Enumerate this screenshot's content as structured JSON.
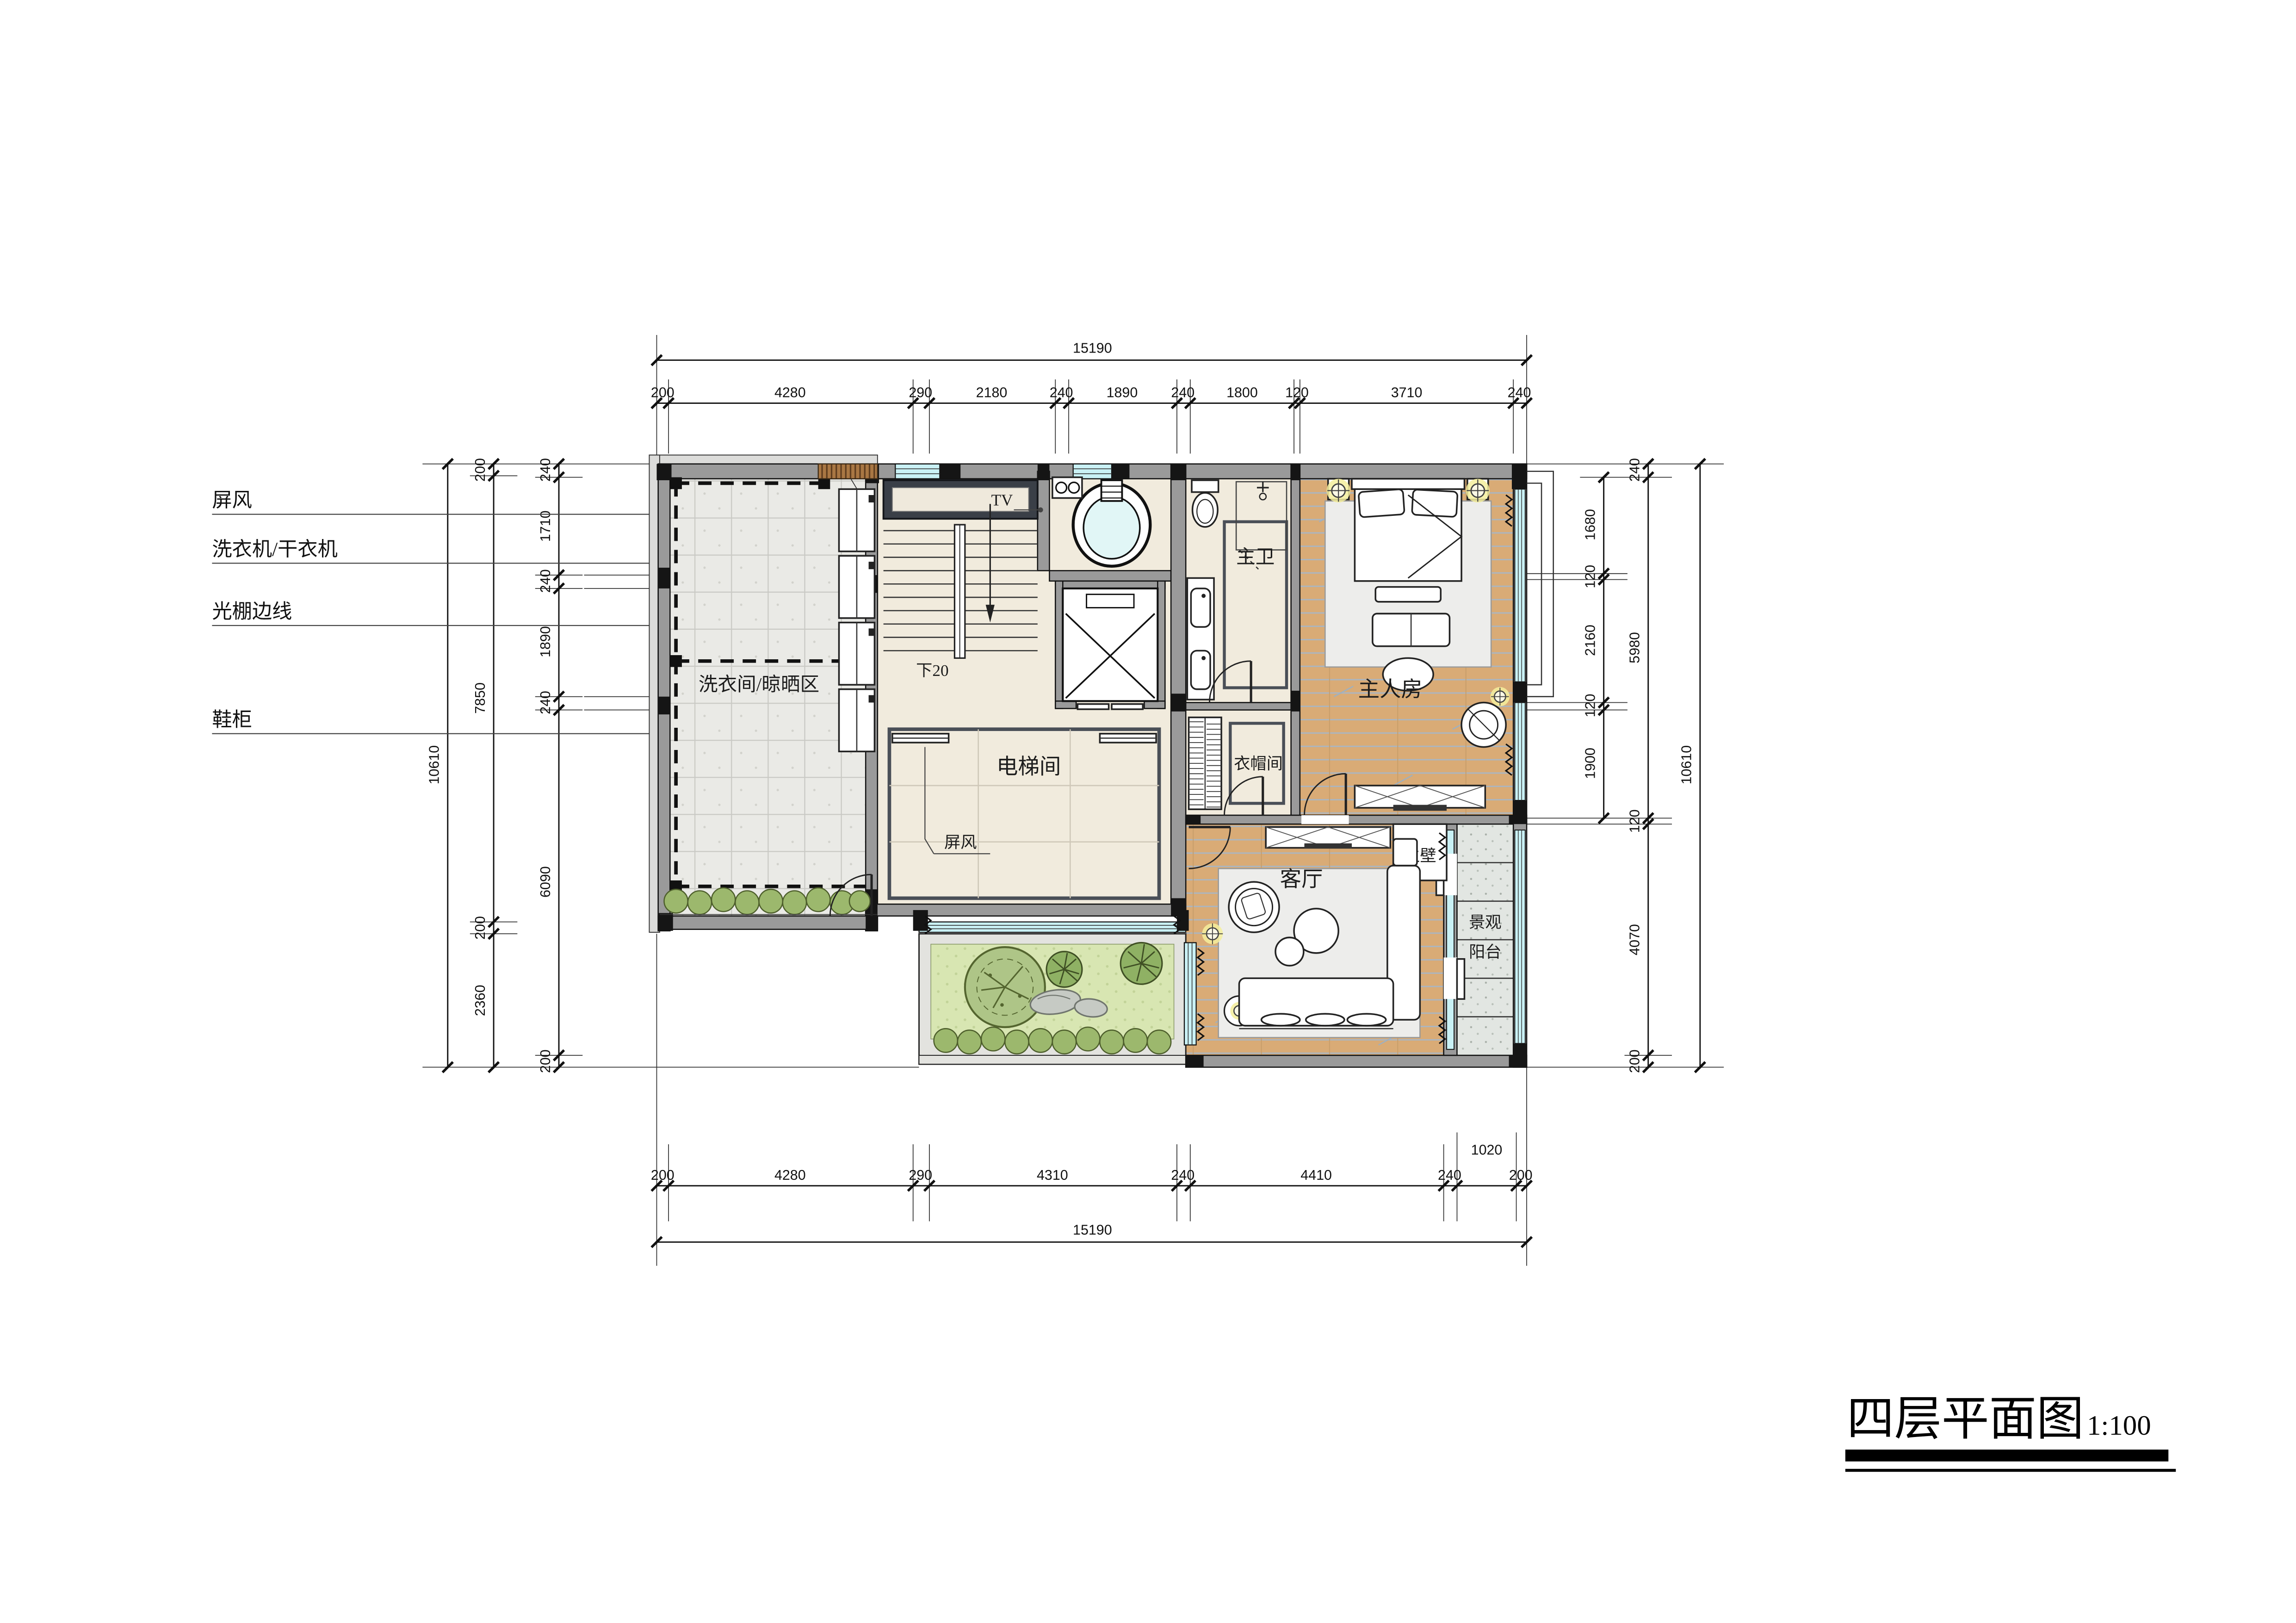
{
  "title": {
    "name": "四层平面图",
    "scale": "1:100"
  },
  "left_annotations": [
    {
      "label": "屏风"
    },
    {
      "label": "洗衣机/干衣机"
    },
    {
      "label": "光棚边线"
    },
    {
      "label": "鞋柜"
    }
  ],
  "rooms": {
    "laundry": "洗衣间/晾晒区",
    "elevator_hall": "电梯间",
    "hall_screen": "屏风",
    "stair_note": "下20",
    "tv": "TV",
    "master_bath": "主卫",
    "cloakroom": "衣帽间",
    "master_bedroom": "主人房",
    "living_room": "客厅",
    "feature_wall": "主壁",
    "balcony_line1": "景观",
    "balcony_line2": "阳台"
  },
  "dims": {
    "top": {
      "total": "15190",
      "chain": [
        "200",
        "4280",
        "290",
        "2180",
        "240",
        "1890",
        "240",
        "1800",
        "120",
        "3710",
        "240"
      ]
    },
    "bottom": {
      "total": "15190",
      "chain": [
        "200",
        "4280",
        "290",
        "4310",
        "240",
        "4410",
        "240",
        "1020",
        "200"
      ]
    },
    "left": {
      "total": "10610",
      "mid_chain": [
        "200",
        "7850",
        "200",
        "2360"
      ],
      "inner_chain": [
        "240",
        "1710",
        "240",
        "1890",
        "240",
        "6090",
        "200"
      ]
    },
    "right": {
      "total": "10610",
      "mid_chain": [
        "240",
        "5980",
        "120",
        "4070",
        "200"
      ],
      "inner_chain": [
        "1680",
        "120",
        "2160",
        "120",
        "1900"
      ]
    }
  },
  "colors": {
    "wall": "#9a9a9a",
    "column": "#151515",
    "window_glass": "#c9f1f5",
    "wood_floor": "#d9ab76",
    "tile": "#f1ebdd",
    "laundry_tile": "#eaeae6",
    "lawn": "#d8e6b2",
    "rug": "#ededeb",
    "granite": "#e2e6e2",
    "light_glow": "#f5ee9e",
    "marble_dark": "#3a3f47",
    "paving": "#dcdcda"
  }
}
